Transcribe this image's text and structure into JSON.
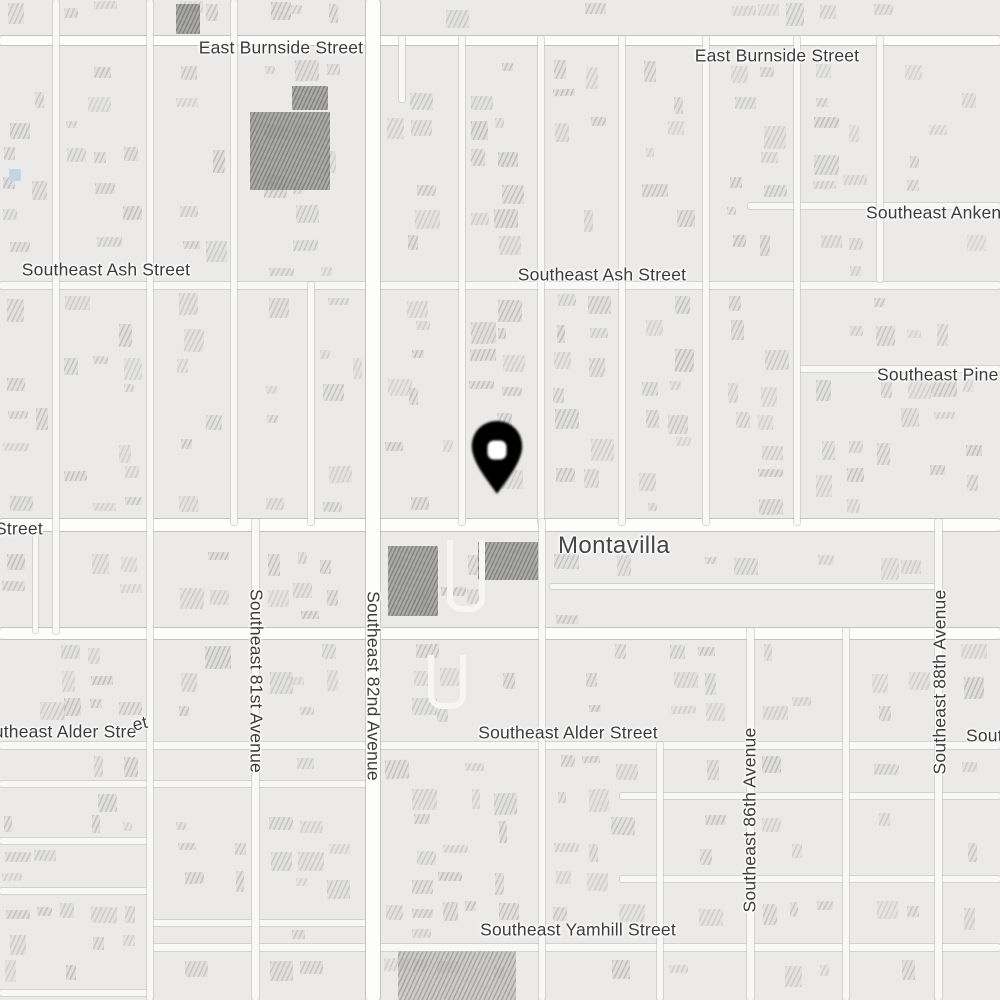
{
  "map": {
    "type": "street-map",
    "neighborhood": "Montavilla",
    "pin": {
      "name": "location-pin"
    },
    "labels": [
      {
        "id": "burnside-west",
        "text": "East Burnside Street"
      },
      {
        "id": "burnside-east",
        "text": "East Burnside Street"
      },
      {
        "id": "ankeny",
        "text": "Southeast Ankeny Street"
      },
      {
        "id": "ash-west",
        "text": "Southeast Ash Street"
      },
      {
        "id": "ash-center",
        "text": "Southeast Ash Street"
      },
      {
        "id": "pine",
        "text": "Southeast Pine Street"
      },
      {
        "id": "stark-cut",
        "text": "Street"
      },
      {
        "id": "montavilla",
        "text": "Montavilla"
      },
      {
        "id": "ave-81st",
        "text": "Southeast 81st Avenue"
      },
      {
        "id": "ave-82nd",
        "text": "Southeast 82nd Avenue"
      },
      {
        "id": "alder-west",
        "text_main": "Southeast Alder Stre",
        "text_tail": "et"
      },
      {
        "id": "alder-center",
        "text": "Southeast Alder Street"
      },
      {
        "id": "ave-86th",
        "text": "Southeast 86th Avenue"
      },
      {
        "id": "ave-88th",
        "text": "Southeast 88th Avenue"
      },
      {
        "id": "yamhill",
        "text": "Southeast Yamhill Street"
      },
      {
        "id": "edge-southeast",
        "text": "Southeast"
      }
    ],
    "colors": {
      "background": "#ebeae8",
      "road_minor": "#f8f8f6",
      "road_major": "#fdfdfb",
      "road_casing": "#d9d8d6",
      "building": "#d2d1cf",
      "building_dark": "#a6a5a3",
      "label_text": "#3c3c3c",
      "neighborhood_text": "#454545",
      "pin": "#000000",
      "pin_hole": "#ffffff",
      "water": "#c3d6e6"
    }
  }
}
